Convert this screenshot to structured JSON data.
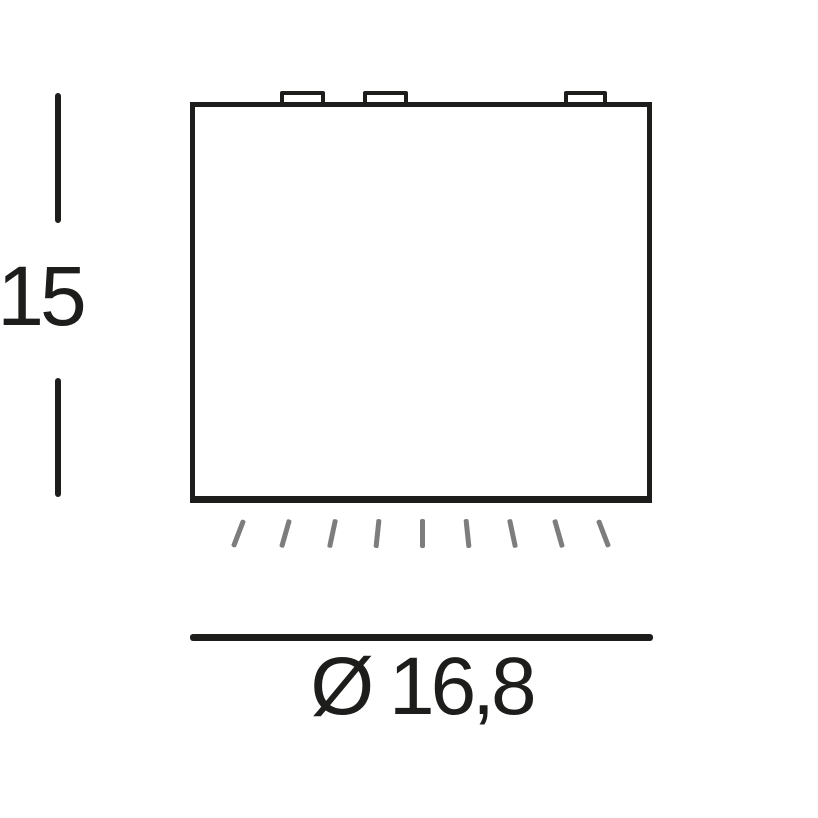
{
  "drawing": {
    "type": "technical-dimension-diagram",
    "colors": {
      "background": "#ffffff",
      "line": "#1d1d1b",
      "light_ray": "#7d7d7d"
    },
    "dimensions": {
      "height": {
        "label": "15"
      },
      "diameter": {
        "label": "Ø 16,8"
      }
    },
    "figure": {
      "mounting_tabs_count": 3,
      "light_rays_count": 9
    }
  }
}
